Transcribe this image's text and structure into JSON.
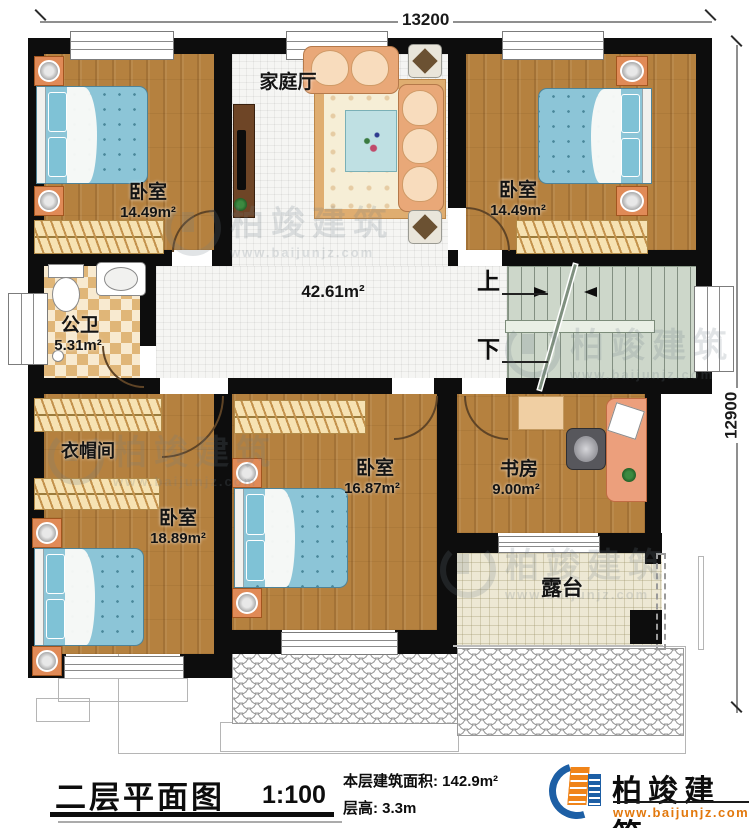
{
  "dimensions": {
    "top": "13200",
    "right": "12900"
  },
  "rooms": {
    "family_hall": {
      "name": "家庭厅"
    },
    "hall": {
      "area": "42.61m²"
    },
    "bedroom_top_left": {
      "name": "卧室",
      "area": "14.49m²"
    },
    "bedroom_top_right": {
      "name": "卧室",
      "area": "14.49m²"
    },
    "bathroom": {
      "name": "公卫",
      "area": "5.31m²"
    },
    "cloakroom": {
      "name": "衣帽间"
    },
    "bedroom_bottom_left": {
      "name": "卧室",
      "area": "18.89m²"
    },
    "bedroom_middle": {
      "name": "卧室",
      "area": "16.87m²"
    },
    "study": {
      "name": "书房",
      "area": "9.00m²"
    },
    "terrace": {
      "name": "露台"
    }
  },
  "stairs": {
    "up": "上",
    "down": "下"
  },
  "watermark": {
    "brand": "柏竣建筑",
    "url": "www.baijunjz.com"
  },
  "title_block": {
    "title": "二层平面图",
    "scale": "1:100",
    "floor_area": "本层建筑面积: 142.9m²",
    "floor_height": "层高: 3.3m"
  },
  "logo": {
    "brand": "柏竣建筑",
    "url": "www.baijunjz.com"
  }
}
